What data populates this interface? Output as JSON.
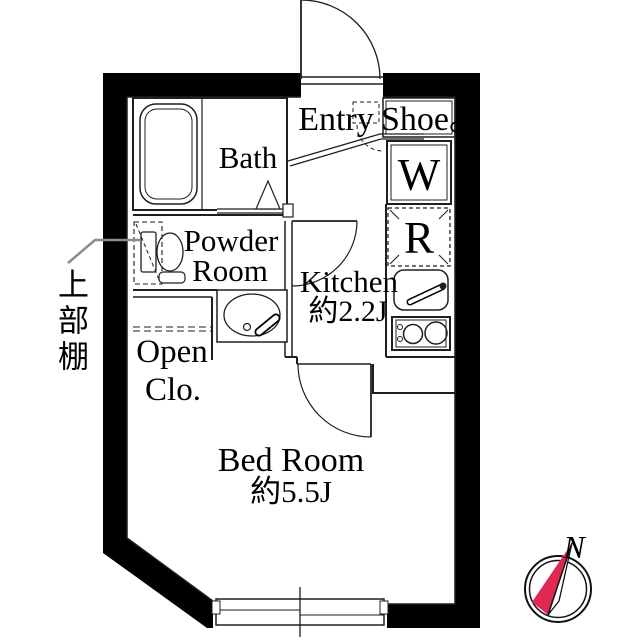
{
  "rooms": {
    "entry": {
      "label": "Entry"
    },
    "shoe_box": {
      "label": "Shoe。"
    },
    "bath": {
      "label": "Bath"
    },
    "powder_room": {
      "label_line1": "Powder",
      "label_line2": "Room"
    },
    "kitchen": {
      "label_line1": "Kitchen",
      "label_line2": "約2.2J"
    },
    "washer": {
      "label": "W"
    },
    "refrigerator": {
      "label": "R"
    },
    "open_closet": {
      "label_line1": "Open",
      "label_line2": "Clo."
    },
    "bedroom": {
      "label_line1": "Bed Room",
      "label_line2": "約5.5J"
    }
  },
  "annotations": {
    "upper_shelf_label": "上部棚"
  },
  "compass": {
    "north_label": "N",
    "needle_color": "#e02950"
  },
  "colors": {
    "wall": "#000000",
    "line": "#1f1f1f",
    "background": "#ffffff"
  }
}
